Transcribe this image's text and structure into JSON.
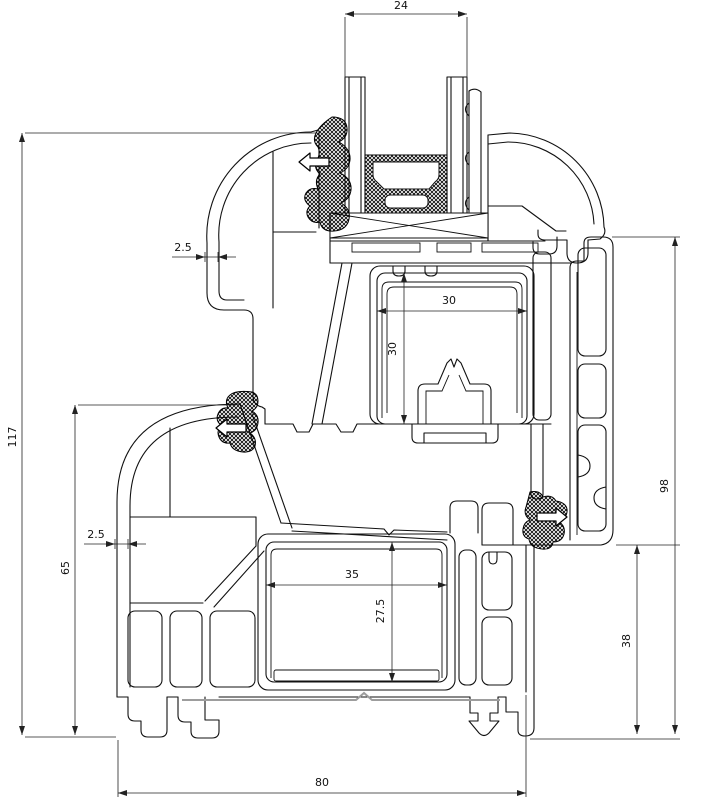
{
  "title": "PVC window frame and sash profile cross-section",
  "colors": {
    "line": "#111111",
    "background": "#ffffff",
    "dimension": "#222222",
    "steel_gray": "#9d9d9d",
    "gasket_fill": "#000000"
  },
  "dimensions": [
    {
      "id": "glazing-width",
      "value": "24",
      "axis": "x",
      "style": "in",
      "line": [
        345,
        14,
        467,
        14
      ],
      "label": [
        401,
        9,
        0
      ],
      "exts": [
        [
          345,
          17,
          345,
          78
        ],
        [
          467,
          17,
          467,
          78
        ]
      ]
    },
    {
      "id": "sash-wall-thickness",
      "value": "2.5",
      "axis": "x",
      "style": "out",
      "line": [
        172,
        257,
        236,
        257
      ],
      "tips": [
        205,
        218
      ],
      "label": [
        183,
        251,
        0
      ],
      "exts": []
    },
    {
      "id": "frame-wall-thickness",
      "value": "2.5",
      "axis": "x",
      "style": "out",
      "line": [
        84,
        544,
        146,
        544
      ],
      "tips": [
        115,
        128
      ],
      "label": [
        96,
        538,
        0
      ],
      "exts": []
    },
    {
      "id": "overall-height",
      "value": "117",
      "axis": "y",
      "style": "in",
      "line": [
        22,
        133,
        22,
        735
      ],
      "label": [
        16,
        437,
        -90
      ],
      "exts": [
        [
          25,
          133,
          316,
          133
        ],
        [
          25,
          737,
          116,
          737
        ]
      ]
    },
    {
      "id": "frame-height",
      "value": "65",
      "axis": "y",
      "style": "in",
      "line": [
        75,
        405,
        75,
        735
      ],
      "label": [
        69,
        568,
        -90
      ],
      "exts": [
        [
          78,
          405,
          236,
          405
        ]
      ]
    },
    {
      "id": "sash-chamber-width",
      "value": "30",
      "axis": "x",
      "style": "in",
      "line": [
        377,
        311,
        527,
        311
      ],
      "label": [
        449,
        304,
        0
      ],
      "exts": []
    },
    {
      "id": "sash-chamber-height",
      "value": "30",
      "axis": "y",
      "style": "in",
      "line": [
        404,
        273,
        404,
        424
      ],
      "label": [
        396,
        349,
        -90
      ],
      "exts": []
    },
    {
      "id": "frame-chamber-width",
      "value": "35",
      "axis": "x",
      "style": "in",
      "line": [
        266,
        585,
        447,
        585
      ],
      "label": [
        352,
        578,
        0
      ],
      "exts": []
    },
    {
      "id": "frame-chamber-height",
      "value": "27.5",
      "axis": "y",
      "style": "in",
      "line": [
        392,
        542,
        392,
        682
      ],
      "label": [
        384,
        611,
        -90
      ],
      "exts": []
    },
    {
      "id": "lower-setback-height",
      "value": "38",
      "axis": "y",
      "style": "in",
      "line": [
        637,
        545,
        637,
        734
      ],
      "label": [
        630,
        641,
        -90
      ],
      "exts": [
        [
          616,
          545,
          680,
          545
        ]
      ]
    },
    {
      "id": "outer-frame-height",
      "value": "98",
      "axis": "y",
      "style": "in",
      "line": [
        675,
        237,
        675,
        734
      ],
      "label": [
        668,
        486,
        -90
      ],
      "exts": [
        [
          612,
          237,
          680,
          237
        ],
        [
          530,
          739,
          680,
          739
        ]
      ]
    },
    {
      "id": "frame-depth",
      "value": "80",
      "axis": "x",
      "style": "in",
      "line": [
        118,
        793,
        526,
        793
      ],
      "label": [
        322,
        786,
        0
      ],
      "exts": [
        [
          118,
          740,
          118,
          797
        ],
        [
          526,
          695,
          526,
          797
        ]
      ]
    }
  ],
  "seal_arrows": [
    {
      "id": "outer-seal-arrow-top",
      "dir": "left",
      "tip": [
        299,
        162
      ]
    },
    {
      "id": "outer-seal-arrow-mid",
      "dir": "left",
      "tip": [
        216,
        428
      ]
    },
    {
      "id": "inner-seal-arrow",
      "dir": "right",
      "tip": [
        567,
        517
      ]
    }
  ]
}
